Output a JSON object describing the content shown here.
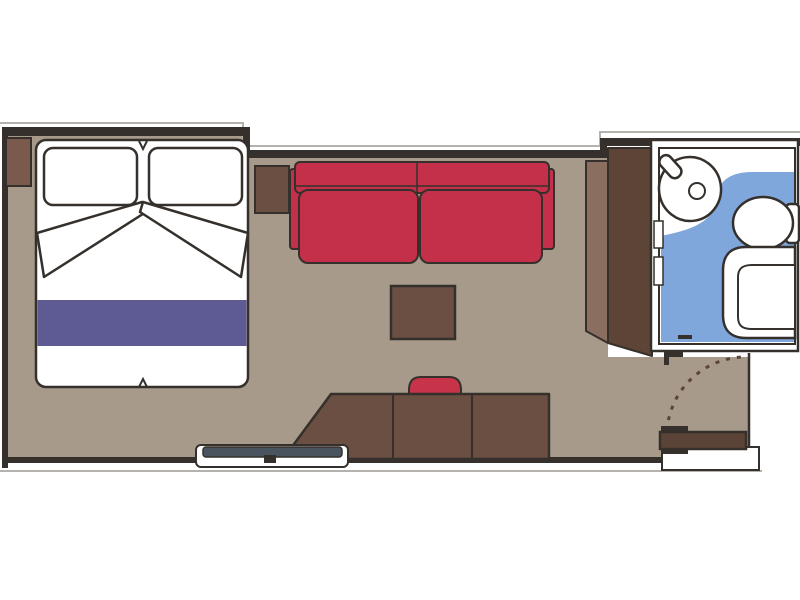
{
  "meta": {
    "type": "floor-plan",
    "subject": "cruise-cabin-stateroom-plan"
  },
  "colors": {
    "outline": "#35302b",
    "wall": "#35302b",
    "line_gray": "#b5b1ad",
    "floor_tan": "#a79a8a",
    "bath_blue": "#7fa7db",
    "sofa_red": "#c43049",
    "chair_red": "#c7344a",
    "bed_runner_purple": "#5d5a94",
    "wood_dark": "#6b4f43",
    "wood_medium": "#7a5a4c",
    "wood_light": "#8a6e5f",
    "wardrobe_dark": "#5e4337",
    "door_brown": "#5c4337",
    "bench_slate": "#4a545e",
    "white": "#ffffff"
  },
  "areas": [
    {
      "name": "main-cabin",
      "floor_color": "#a79a8a"
    },
    {
      "name": "bathroom",
      "floor_color": "#7fa7db"
    },
    {
      "name": "entry-vestibule",
      "floor_color": "#a79a8a"
    }
  ],
  "furniture": [
    {
      "name": "double-bed",
      "details": [
        "pillow-left",
        "pillow-right",
        "turned-sheet-left",
        "turned-sheet-right",
        "purple-bed-runner"
      ]
    },
    {
      "name": "nightstand"
    },
    {
      "name": "sofa-side-table"
    },
    {
      "name": "two-seat-sofa",
      "color": "#c43049"
    },
    {
      "name": "coffee-table"
    },
    {
      "name": "desk-vanity",
      "sections": 3
    },
    {
      "name": "desk-chair",
      "color": "#c7344a"
    },
    {
      "name": "luggage-bench"
    },
    {
      "name": "wardrobe",
      "panels": 2
    },
    {
      "name": "washbasin"
    },
    {
      "name": "toilet"
    },
    {
      "name": "shower"
    },
    {
      "name": "entry-door",
      "swing": "dashed-arc"
    }
  ]
}
